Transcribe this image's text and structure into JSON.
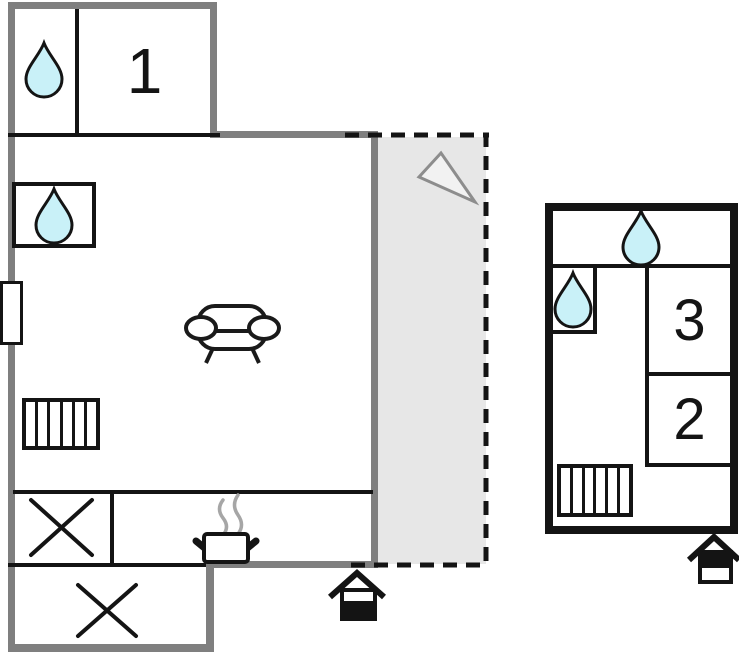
{
  "floorplan": {
    "rooms": {
      "room1": {
        "label": "1"
      },
      "room2": {
        "label": "2"
      },
      "room3": {
        "label": "3"
      }
    },
    "icons": {
      "water_drop": {
        "count": 4,
        "fill": "#c9f1f8"
      },
      "sofa": {
        "count": 1
      },
      "radiator": {
        "count": 2
      },
      "stove_pot_with_steam": {
        "count": 1
      },
      "entrance_house": {
        "count": 2
      },
      "compass_arrow": {
        "count": 1
      },
      "window": {
        "count": 1
      },
      "cross_mark": {
        "count": 2
      }
    },
    "colors": {
      "outer_wall_gray": "#7f7f7f",
      "inner_wall_black": "#141414",
      "terrace_fill": "#e7e7e7",
      "water_drop_fill": "#c9f1f8",
      "steam_gray": "#a6a6a6",
      "compass_arrow_stroke": "#8d8d8d",
      "background": "#ffffff"
    }
  }
}
